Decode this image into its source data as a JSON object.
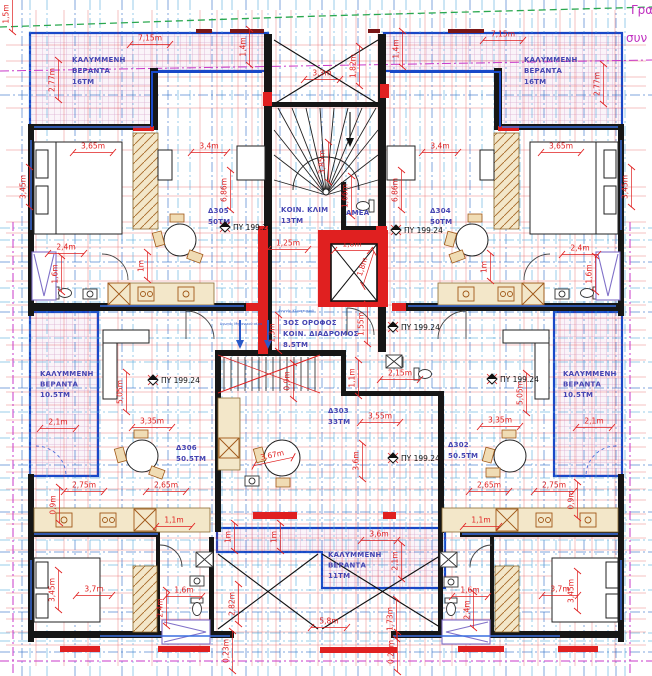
{
  "sheet": {
    "corner_top": "Γρα",
    "corner_bottom": "συν"
  },
  "colors": {
    "dim": "#e02020",
    "room": "#4545b2",
    "boundary": "#c838c8",
    "grid_light": "#56aadd",
    "grid_dark": "#2b6cc8",
    "wall": "#161616",
    "window": "#1848c8",
    "firewall": "#e02020",
    "green": "#2aa84f"
  },
  "rooms": [
    {
      "id": "veranda-tl",
      "lines": [
        "ΚΑΛΥΜΜΕΝΗ",
        "ΒΕΡΑΝΤΑ",
        "16ΤΜ"
      ],
      "x": 72,
      "y": 62,
      "dy": 11
    },
    {
      "id": "veranda-tr",
      "lines": [
        "ΚΑΛΥΜΜΕΝΗ",
        "ΒΕΡΑΝΤΑ",
        "16ΤΜ"
      ],
      "x": 524,
      "y": 62,
      "dy": 11
    },
    {
      "id": "unit-d305",
      "lines": [
        "Δ305",
        "50ΤΜ"
      ],
      "x": 208,
      "y": 213,
      "dy": 11
    },
    {
      "id": "stair-core",
      "lines": [
        "ΚΟΙΝ. ΚΛΙΜ",
        "13ΤΜ"
      ],
      "x": 281,
      "y": 212,
      "dy": 11
    },
    {
      "id": "amea-wc",
      "lines": [
        "ΑΜΕΑ"
      ],
      "x": 346,
      "y": 215,
      "dy": 11
    },
    {
      "id": "unit-d304",
      "lines": [
        "Δ304",
        "50ΤΜ"
      ],
      "x": 430,
      "y": 213,
      "dy": 11
    },
    {
      "id": "corridor",
      "lines": [
        "3ΟΣ ΟΡΟΦΟΣ",
        "ΚΟΙΝ. ΔΙΑΔΡΟΜΟΣ",
        "8.5ΤΜ"
      ],
      "x": 283,
      "y": 325,
      "dy": 11
    },
    {
      "id": "veranda-ml",
      "lines": [
        "ΚΑΛΥΜΜΕΝΗ",
        "ΒΕΡΑΝΤΑ",
        "10.5ΤΜ"
      ],
      "x": 40,
      "y": 376,
      "dy": 10.5
    },
    {
      "id": "veranda-mr",
      "lines": [
        "ΚΑΛΥΜΜΕΝΗ",
        "ΒΕΡΑΝΤΑ",
        "10.5ΤΜ"
      ],
      "x": 563,
      "y": 376,
      "dy": 10.5
    },
    {
      "id": "unit-d303",
      "lines": [
        "Δ303",
        "33ΤΜ"
      ],
      "x": 328,
      "y": 413,
      "dy": 11
    },
    {
      "id": "unit-d306",
      "lines": [
        "Δ306",
        "50.5ΤΜ"
      ],
      "x": 176,
      "y": 450,
      "dy": 11
    },
    {
      "id": "unit-d302",
      "lines": [
        "Δ302",
        "50.5ΤΜ"
      ],
      "x": 448,
      "y": 447,
      "dy": 11
    },
    {
      "id": "veranda-bottom",
      "lines": [
        "ΚΑΛΥΜΜΕΝΗ",
        "ΒΕΡΑΝΤΑ",
        "11ΤΜ"
      ],
      "x": 328,
      "y": 557,
      "dy": 10.5
    }
  ],
  "dims": [
    [
      "1,5m",
      10,
      14,
      -90
    ],
    [
      "7,15m",
      150,
      42,
      0
    ],
    [
      "7,15m",
      503,
      38,
      0
    ],
    [
      "1,4m",
      247,
      47,
      -90
    ],
    [
      "1,4m",
      400,
      49,
      -90
    ],
    [
      "1,82m",
      357,
      66,
      -90
    ],
    [
      "3,3m",
      322,
      77,
      0
    ],
    [
      "2,77m",
      56,
      80,
      -90
    ],
    [
      "2,77m",
      601,
      84,
      -90
    ],
    [
      "3,65m",
      93,
      150,
      0
    ],
    [
      "3,4m",
      209,
      150,
      0
    ],
    [
      "3,4m",
      440,
      150,
      0
    ],
    [
      "3,65m",
      561,
      150,
      0
    ],
    [
      "3,45m",
      27,
      187,
      -90
    ],
    [
      "3,45m",
      629,
      187,
      -90
    ],
    [
      "6,86m",
      228,
      190,
      -90
    ],
    [
      "6,86m",
      399,
      190,
      -90
    ],
    [
      "3,85m",
      326,
      162,
      -90
    ],
    [
      "1,66m",
      349,
      196,
      -90
    ],
    [
      "2,4m",
      66,
      251,
      0
    ],
    [
      "2,4m",
      580,
      252,
      0
    ],
    [
      "1,6m",
      59,
      274,
      -90
    ],
    [
      "1,6m",
      593,
      274,
      -90
    ],
    [
      "1m",
      145,
      266,
      -90
    ],
    [
      "1m",
      488,
      267,
      -90
    ],
    [
      "1,25m",
      288,
      247,
      0
    ],
    [
      "1,8m",
      352,
      248,
      0
    ],
    [
      "1,8m",
      366,
      268,
      -72
    ],
    [
      "1,3m",
      276,
      333,
      -90
    ],
    [
      "1,55m",
      365,
      324,
      -90
    ],
    [
      "0,9m",
      291,
      381,
      -90
    ],
    [
      "1,1m",
      356,
      378,
      -90
    ],
    [
      "2,15m",
      400,
      377,
      0
    ],
    [
      "5,05m",
      124,
      392,
      -90
    ],
    [
      "5,05m",
      524,
      393,
      -90
    ],
    [
      "2,1m",
      58,
      426,
      0
    ],
    [
      "3,35m",
      152,
      425,
      0
    ],
    [
      "3,35m",
      500,
      424,
      0
    ],
    [
      "2,1m",
      594,
      425,
      0
    ],
    [
      "3,55m",
      380,
      420,
      0
    ],
    [
      "3,67m",
      273,
      459,
      -12
    ],
    [
      "3,6m",
      360,
      461,
      -90
    ],
    [
      "2,75m",
      84,
      489,
      0
    ],
    [
      "2,65m",
      166,
      489,
      0
    ],
    [
      "2,65m",
      489,
      489,
      0
    ],
    [
      "2,75m",
      554,
      489,
      0
    ],
    [
      "0,9m",
      57,
      505,
      -90
    ],
    [
      "0,9m",
      575,
      500,
      -90
    ],
    [
      "1,1m",
      174,
      524,
      0
    ],
    [
      "1,1m",
      481,
      524,
      0
    ],
    [
      "1m",
      232,
      537,
      -90
    ],
    [
      "1m",
      278,
      537,
      -90
    ],
    [
      "3,6m",
      379,
      538,
      0
    ],
    [
      "2,1m",
      399,
      561,
      -90
    ],
    [
      "3,45m",
      56,
      590,
      -90
    ],
    [
      "3,7m",
      94,
      593,
      0
    ],
    [
      "3,7m",
      560,
      593,
      0
    ],
    [
      "3,45m",
      575,
      591,
      -90
    ],
    [
      "2,4m",
      164,
      608,
      -90
    ],
    [
      "1,6m",
      184,
      594,
      0
    ],
    [
      "1,6m",
      470,
      594,
      0
    ],
    [
      "2,4m",
      471,
      610,
      -90
    ],
    [
      "2,82m",
      236,
      604,
      -90
    ],
    [
      "1,73m",
      394,
      619,
      -90
    ],
    [
      "5,8m",
      329,
      625,
      0
    ],
    [
      "0,23m",
      230,
      651,
      -90
    ],
    [
      "0,25m",
      395,
      652,
      -90
    ]
  ],
  "py": {
    "label": "ΠΥ 199.24",
    "points": [
      [
        225,
        227
      ],
      [
        396,
        230
      ],
      [
        393,
        327
      ],
      [
        153,
        380
      ],
      [
        492,
        379
      ],
      [
        393,
        458
      ]
    ]
  },
  "ducts": [
    {
      "t": "Αγωγός Κλιματισμού",
      "x": 296,
      "y": 312
    },
    {
      "t": "Αγωγός Μηχανικού αέρα",
      "x": 241,
      "y": 325
    }
  ]
}
